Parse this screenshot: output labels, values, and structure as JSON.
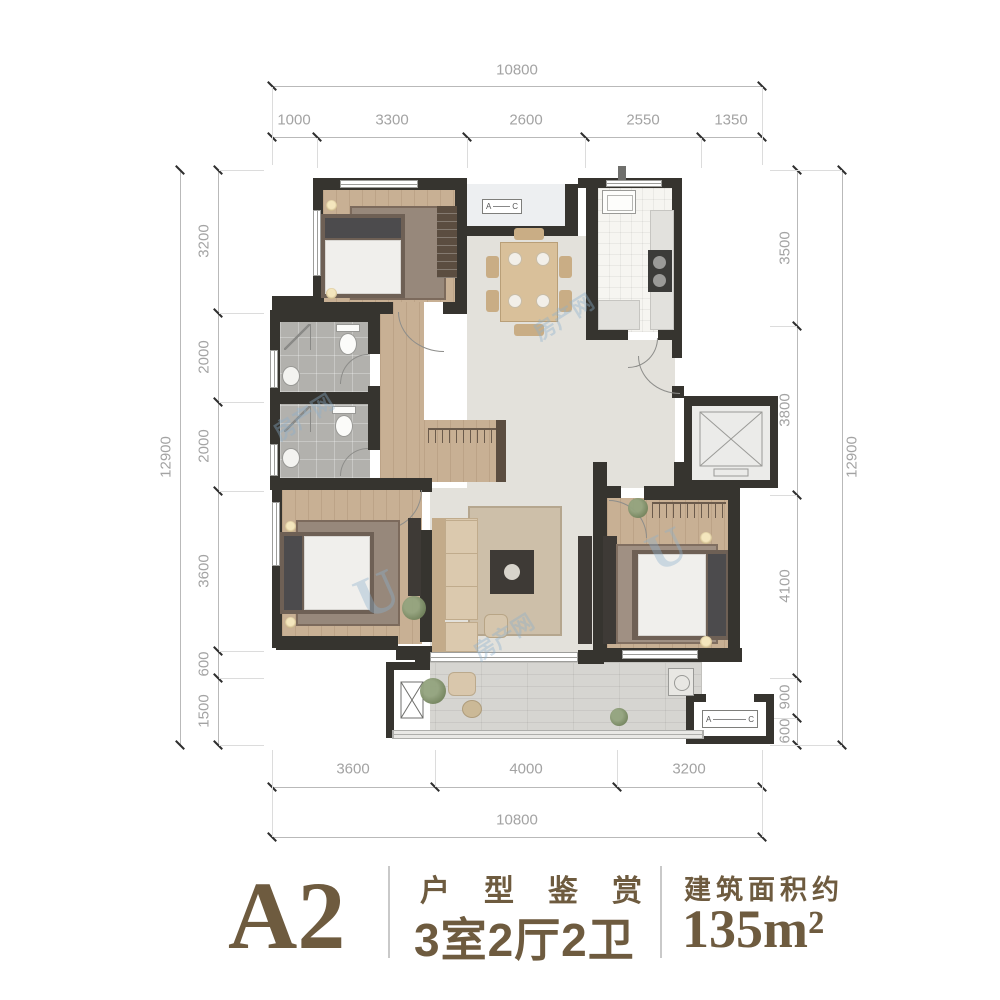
{
  "dims": {
    "top": {
      "total": "10800",
      "segments": [
        "1000",
        "3300",
        "2600",
        "2550",
        "1350"
      ]
    },
    "bottom": {
      "total": "10800",
      "segments": [
        "3600",
        "4000",
        "3200"
      ]
    },
    "left": {
      "total": "12900",
      "segments": [
        "3200",
        "2000",
        "2000",
        "3600",
        "600",
        "1500"
      ]
    },
    "right": {
      "total": "12900",
      "segments": [
        "3500",
        "3800",
        "4100",
        "900",
        "600"
      ]
    }
  },
  "plan": {
    "ac_unit_label": {
      "left": "A",
      "right": "C"
    }
  },
  "watermark": {
    "text": "房产网",
    "letter": "U"
  },
  "footer": {
    "plan_code": "A2",
    "series_title": "户型鉴赏",
    "layout_summary": "3室2厅2卫",
    "area_label": "建筑面积约",
    "area_value": "135m²"
  },
  "colors": {
    "accent": "#6e5b3f",
    "wall": "#36342f",
    "wood": "#c8b094"
  }
}
